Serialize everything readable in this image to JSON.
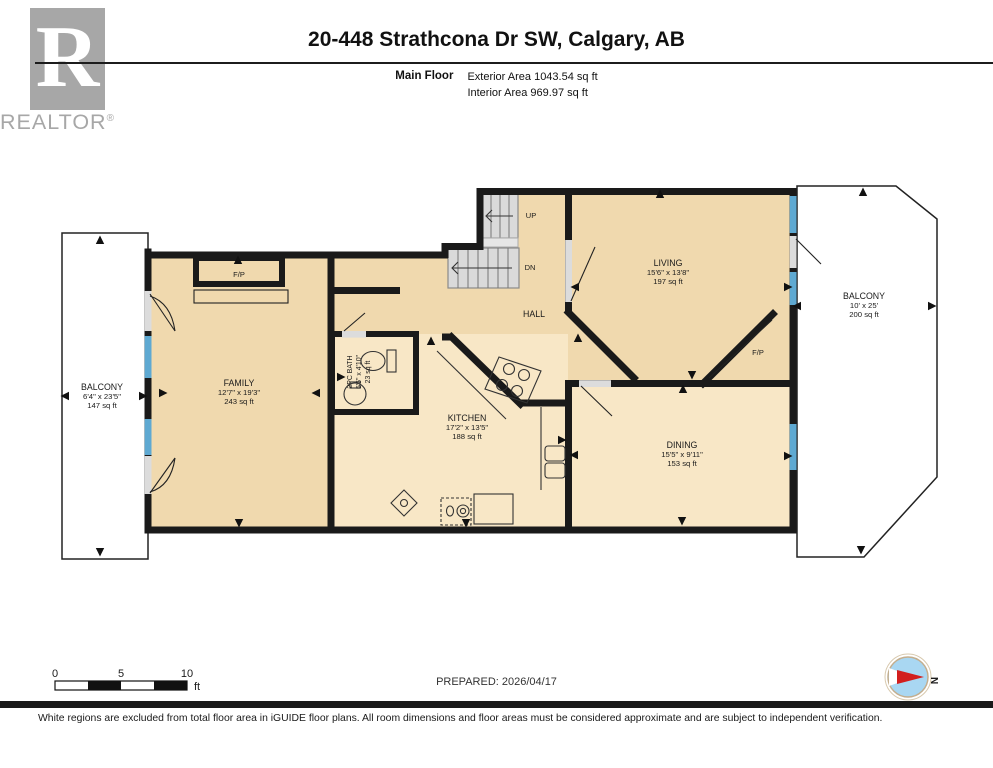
{
  "header": {
    "logo_letter": "R",
    "brand": "REALTOR",
    "brand_reg": "®",
    "title": "20-448 Strathcona Dr SW, Calgary, AB",
    "floor_label": "Main Floor",
    "exterior_area": "Exterior Area 1043.54 sq ft",
    "interior_area": "Interior Area 969.97 sq ft"
  },
  "rooms": {
    "family": {
      "name": "FAMILY",
      "dims": "12'7\" x 19'3\"",
      "area": "243 sq ft"
    },
    "kitchen": {
      "name": "KITCHEN",
      "dims": "17'2\" x 13'5\"",
      "area": "188 sq ft"
    },
    "living": {
      "name": "LIVING",
      "dims": "15'6\" x 13'8\"",
      "area": "197 sq ft"
    },
    "dining": {
      "name": "DINING",
      "dims": "15'5\" x 9'11\"",
      "area": "153 sq ft"
    },
    "bath": {
      "name": "2PC BATH",
      "dims": "5'5\" x 4'10\"",
      "area": "23 sq ft"
    },
    "balcony_left": {
      "name": "BALCONY",
      "dims": "6'4\" x 23'5\"",
      "area": "147 sq ft"
    },
    "balcony_right": {
      "name": "BALCONY",
      "dims": "10' x 25'",
      "area": "200 sq ft"
    },
    "hall": {
      "name": "HALL"
    }
  },
  "labels": {
    "fireplace": "F/P",
    "up": "UP",
    "down": "DN",
    "north": "N"
  },
  "scale_bar": {
    "tick_0": "0",
    "tick_5": "5",
    "tick_10": "10",
    "unit": "ft"
  },
  "footer": {
    "prepared": "PREPARED: 2026/04/17",
    "disclaimer": "White regions are excluded from total floor area in iGUIDE floor plans. All room dimensions and floor areas must be considered approximate and are subject to independent verification."
  },
  "colors": {
    "floor_main": "#f0d9ae",
    "floor_light": "#f8e7c6",
    "wall": "#1a1a1a",
    "window": "#5ea9d2",
    "stairs": "#dadada",
    "balcony": "#ffffff",
    "compass_blue": "#a9d7f2",
    "compass_red": "#d21e1e",
    "brand_gray": "#a7a7a7"
  }
}
